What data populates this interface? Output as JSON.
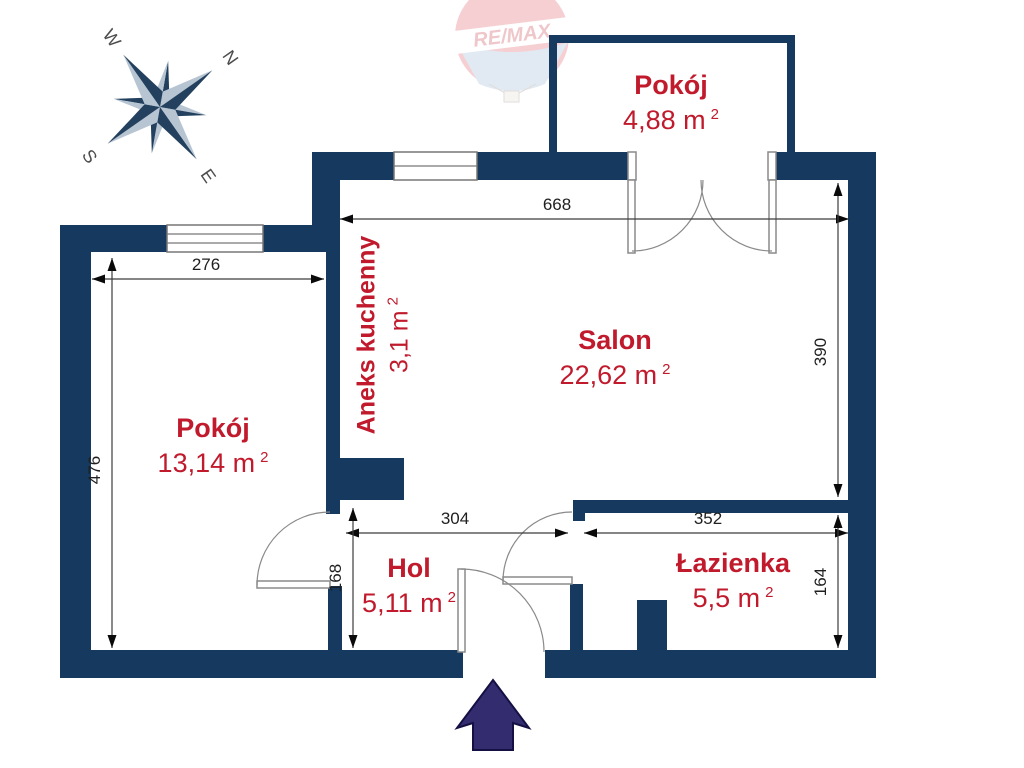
{
  "logo": {
    "brand": "RE/MAX"
  },
  "compass": {
    "n": "N",
    "e": "E",
    "s": "S",
    "w": "W"
  },
  "rooms": [
    {
      "name": "Pokój",
      "area": "4,88 m",
      "sup": "2"
    },
    {
      "name": "Salon",
      "area": "22,62 m",
      "sup": "2"
    },
    {
      "name": "Aneks kuchenny",
      "area": "3,1 m",
      "sup": "2"
    },
    {
      "name": "Pokój",
      "area": "13,14 m",
      "sup": "2"
    },
    {
      "name": "Hol",
      "area": "5,11 m",
      "sup": "2"
    },
    {
      "name": "Łazienka",
      "area": "5,5 m",
      "sup": "2"
    }
  ],
  "dimensions": {
    "salon_width": "668",
    "pokoj_width": "276",
    "pokoj_height": "476",
    "salon_height": "390",
    "hol_width": "304",
    "lazienka_width": "352",
    "hol_height": "168",
    "lazienka_height": "164"
  },
  "colors": {
    "wall": "#16395f",
    "accent_red": "#c01a2c",
    "entrance_arrow": "#332d70"
  }
}
